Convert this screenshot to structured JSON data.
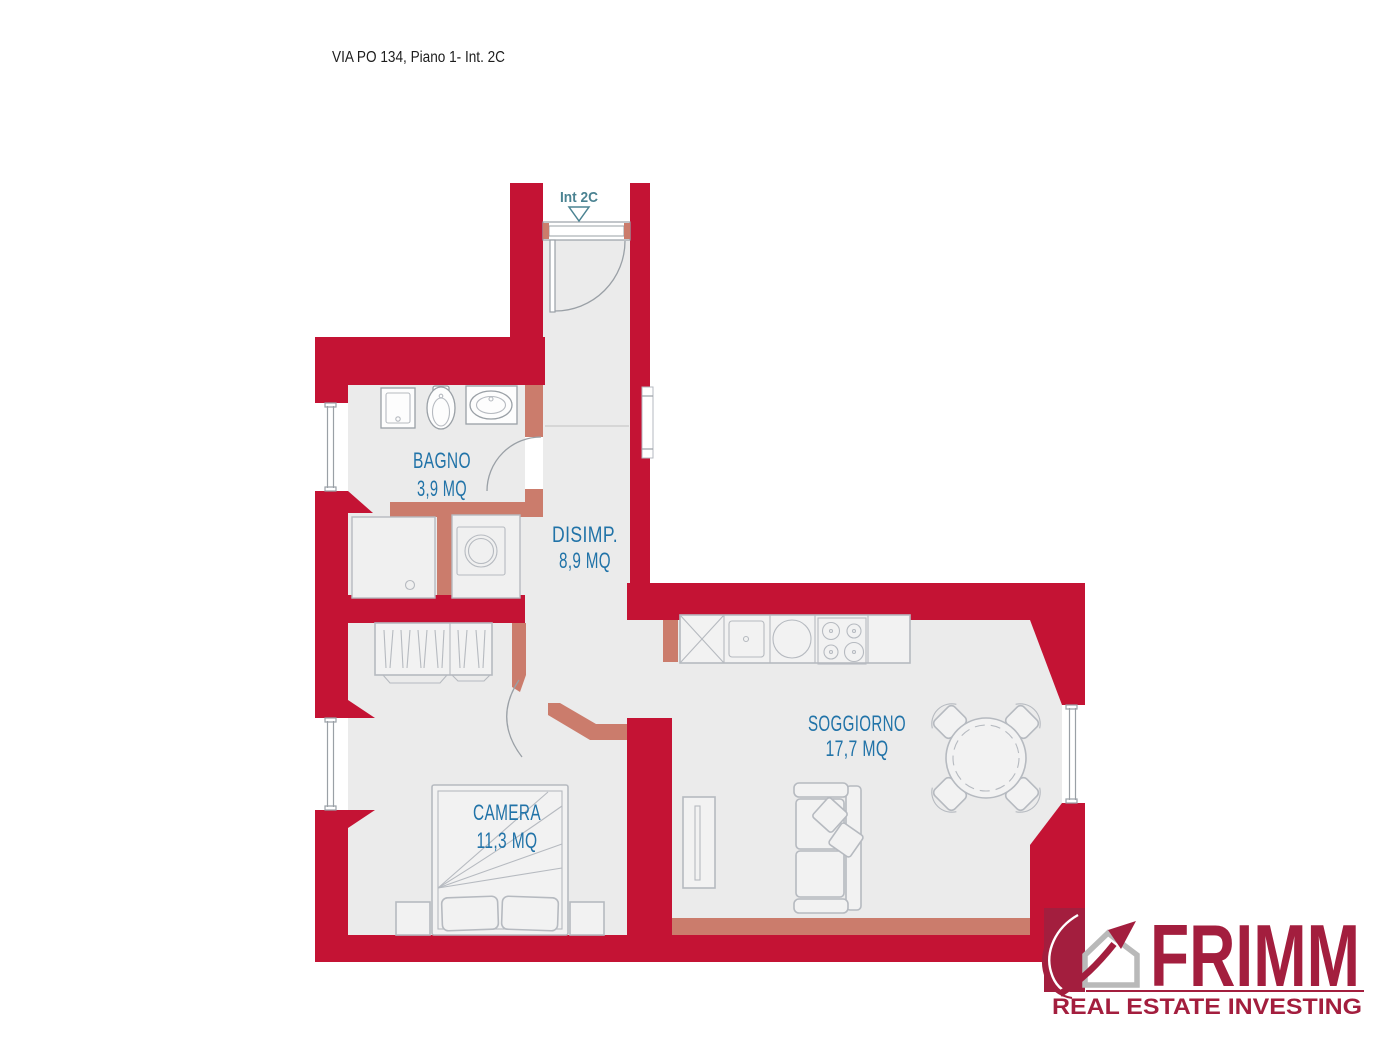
{
  "title": "VIA PO 134, Piano 1- Int. 2C",
  "entrance": {
    "label": "Int 2C"
  },
  "rooms": [
    {
      "id": "bagno",
      "name": "BAGNO",
      "area": "3,9 MQ"
    },
    {
      "id": "disimpegno",
      "name": "DISIMP.",
      "area": "8,9 MQ"
    },
    {
      "id": "camera",
      "name": "CAMERA",
      "area": "11,3 MQ"
    },
    {
      "id": "soggiorno",
      "name": "SOGGIORNO",
      "area": "17,7 MQ"
    }
  ],
  "logo": {
    "brand": "FRIMM",
    "tagline": "REAL ESTATE INVESTING"
  },
  "colors": {
    "wall": "#c41334",
    "partition": "#cb7c6c",
    "floor": "#ebebeb",
    "furniture": "#b6bac0",
    "furniture-dark": "#9aa0a6",
    "label-blue": "#2173a8",
    "entrance-teal": "#4b8392",
    "logo-crimson": "#a31e3e",
    "logo-gray": "#b9b9b9",
    "title-color": "#1d1d1d"
  }
}
